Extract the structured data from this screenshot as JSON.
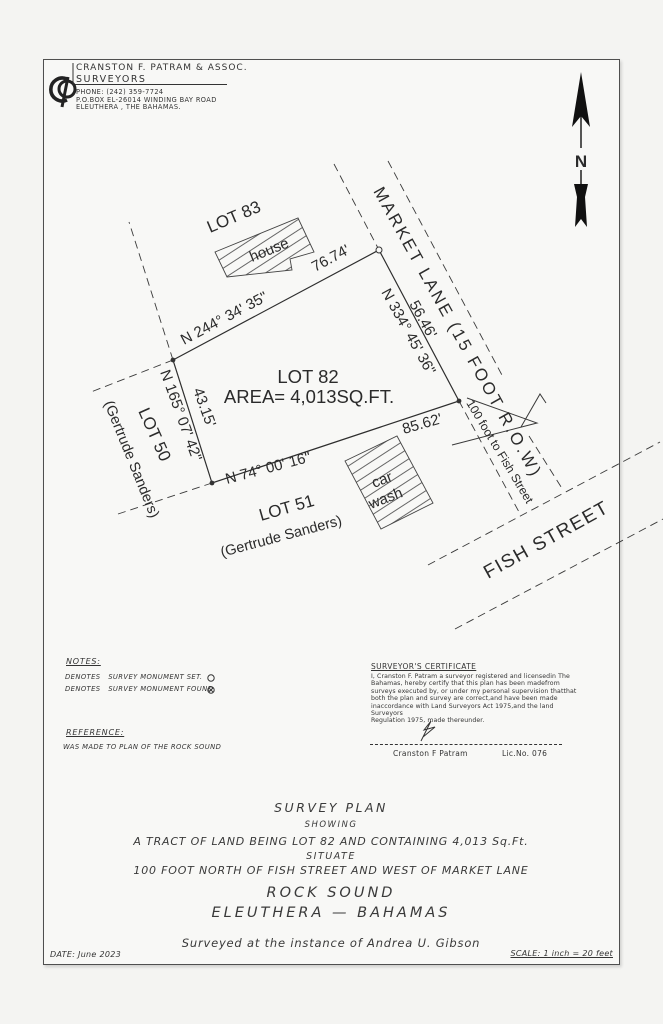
{
  "header": {
    "logo": "CP",
    "firm_name": "CRANSTON F. PATRAM & ASSOC.",
    "firm_type": "SURVEYORS",
    "phone": "PHONE: (242) 359-7724",
    "address1": "P.O.BOX EL-26014 WINDING BAY ROAD",
    "address2": "ELEUTHERA , THE BAHAMAS."
  },
  "compass": {
    "north_label": "N"
  },
  "plan": {
    "lot82": {
      "name": "LOT 82",
      "area": "AREA= 4,013SQ.FT."
    },
    "boundaries": {
      "north": {
        "bearing": "N 244° 34' 35\"",
        "distance": "76.74'"
      },
      "east": {
        "bearing": "N 334° 45' 36\"",
        "distance": "56.46'"
      },
      "south": {
        "bearing": "N 74° 00' 16\"",
        "distance": "85.62'"
      },
      "west": {
        "bearing": "N 165° 07' 42\"",
        "distance": "43.15'"
      }
    },
    "adjacent": {
      "lot83": "LOT 83",
      "lot50": "LOT 50",
      "lot50_owner": "(Gertrude Sanders)",
      "lot51": "LOT 51",
      "lot51_owner": "(Gertrude Sanders)"
    },
    "roads": {
      "market_lane": "MARKET LANE (15 FOOT R.O.W)",
      "fish_street": "FISH STREET",
      "distance_note": "100 foot to Fish Street"
    },
    "buildings": {
      "house": "house",
      "car_wash_line1": "car",
      "car_wash_line2": "wash"
    }
  },
  "notes": {
    "title": "NOTES:",
    "set_line": "DENOTES   SURVEY MONUMENT SET.",
    "found_line": "DENOTES   SURVEY MONUMENT FOUND."
  },
  "reference": {
    "title": "REFERENCE:",
    "body": "WAS MADE TO PLAN OF THE ROCK SOUND"
  },
  "certificate": {
    "title": "SURVEYOR'S CERTIFICATE",
    "body": [
      "I, Cranston F. Patram a surveyor registered and licensedin The",
      "Bahamas, hereby certify that this plan has been madefrom",
      "surveys executed by, or under my personal supervision thatthat",
      "both the plan and survey are correct,and have been made",
      "inaccordance with Land Surveyors Act 1975,and the land",
      "Surveyors",
      "Regulation 1975, made thereunder."
    ],
    "signature_name": "Cranston F Patram",
    "license": "Lic.No. 076"
  },
  "title_block": {
    "line1": "SURVEY PLAN",
    "line2": "SHOWING",
    "line3": "A TRACT OF LAND BEING LOT 82 AND CONTAINING 4,013 Sq.Ft.",
    "line4": "SITUATE",
    "line5": "100 FOOT NORTH OF FISH STREET AND WEST OF MARKET LANE",
    "line6": "ROCK SOUND",
    "line7": "ELEUTHERA — BAHAMAS",
    "line8": "Surveyed at the instance of Andrea U. Gibson"
  },
  "footer": {
    "date": "DATE: June 2023",
    "scale": "SCALE: 1 inch = 20 feet"
  }
}
